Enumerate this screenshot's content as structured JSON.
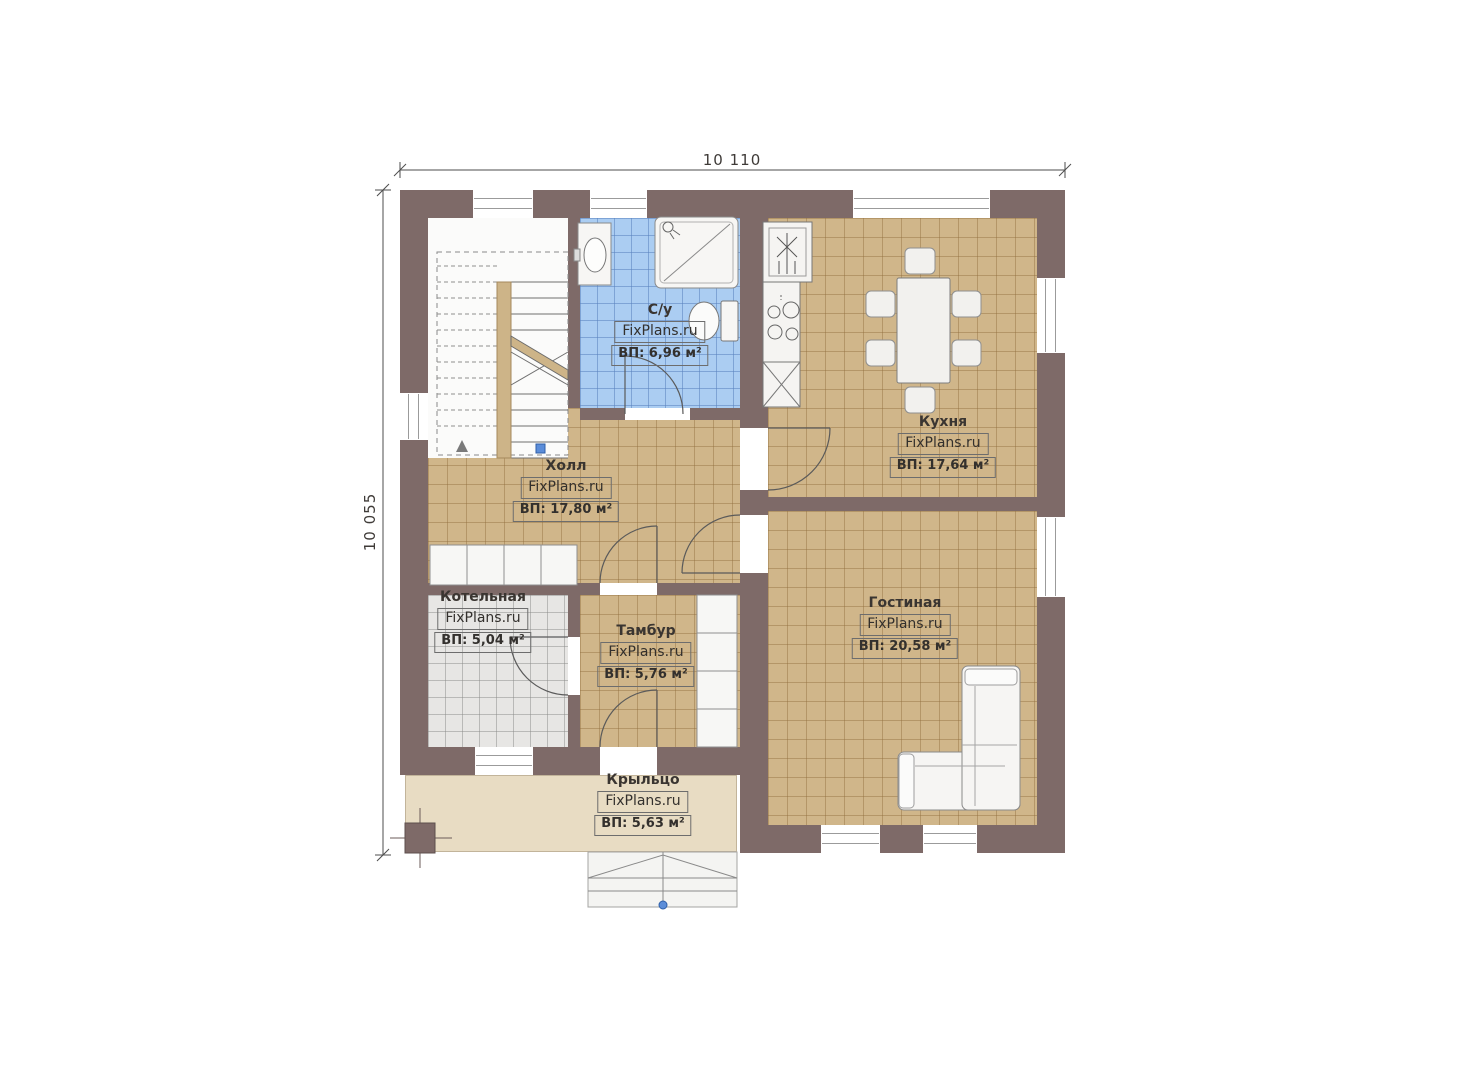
{
  "watermark": "FixPlans.ru",
  "dimensions": {
    "width_label": "10 110",
    "height_label": "10 055"
  },
  "rooms": {
    "bathroom": {
      "name": "С/у",
      "area": "ВП: 6,96 м²"
    },
    "kitchen": {
      "name": "Кухня",
      "area": "ВП: 17,64 м²"
    },
    "hall": {
      "name": "Холл",
      "area": "ВП: 17,80 м²"
    },
    "boiler": {
      "name": "Котельная",
      "area": "ВП: 5,04 м²"
    },
    "vestibule": {
      "name": "Тамбур",
      "area": "ВП: 5,76 м²"
    },
    "living": {
      "name": "Гостиная",
      "area": "ВП: 20,58 м²"
    },
    "porch": {
      "name": "Крыльцо",
      "area": "ВП: 5,63 м²"
    }
  },
  "colors": {
    "wall": "#7e6a68",
    "floor_wood": "#d0b68a",
    "floor_bath": "#abcdf2",
    "floor_boiler": "#e7e6e4",
    "porch": "#e8dcc3",
    "marker_blue": "#5b8dd9"
  }
}
